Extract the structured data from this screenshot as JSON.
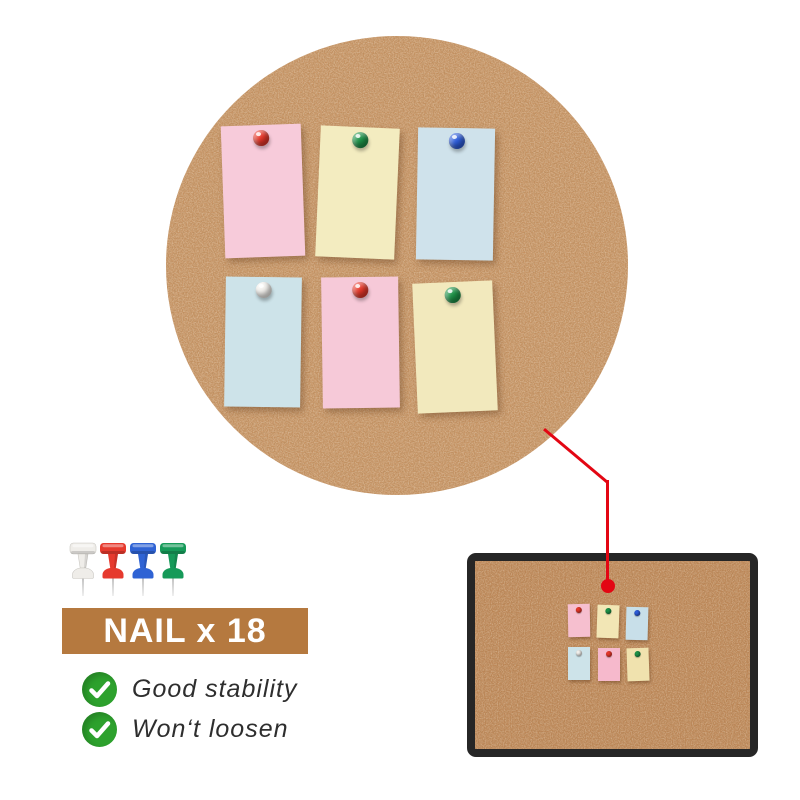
{
  "scene": {
    "type": "product-graphic",
    "subject": "cork board with push pins and sticky notes"
  },
  "hero_board": {
    "shape": "circle",
    "cork_color": "#c89363",
    "notes": [
      {
        "note": "pink",
        "note_color": "#f7cbda",
        "pin": "red",
        "pin_color": "#e8382a"
      },
      {
        "note": "yellow",
        "note_color": "#f3ecc0",
        "pin": "green",
        "pin_color": "#1d9348"
      },
      {
        "note": "blue",
        "note_color": "#cfe2eb",
        "pin": "blue",
        "pin_color": "#2d5ddb"
      },
      {
        "note": "blue",
        "note_color": "#cde3e9",
        "pin": "white",
        "pin_color": "#f4f2ee"
      },
      {
        "note": "pink",
        "note_color": "#f6c9d8",
        "pin": "red",
        "pin_color": "#e8382a"
      },
      {
        "note": "yellow",
        "note_color": "#f2e9bd",
        "pin": "green",
        "pin_color": "#1d9348"
      }
    ]
  },
  "connector": {
    "color": "#e30613"
  },
  "pin_samples": [
    {
      "name": "white",
      "color": "#efede9"
    },
    {
      "name": "red",
      "color": "#e63a2e"
    },
    {
      "name": "blue",
      "color": "#2f63d4"
    },
    {
      "name": "green",
      "color": "#169a59"
    }
  ],
  "banner": {
    "label": "NAIL x 18",
    "bg_color": "#b5793f",
    "text_color": "#ffffff"
  },
  "features": [
    {
      "label": "Good stability",
      "check_color": "#2da12d"
    },
    {
      "label": "Won‘t loosen",
      "check_color": "#2da12d"
    }
  ],
  "mini_board": {
    "frame_color": "#262626",
    "cork_color": "#bf8757",
    "notes": [
      {
        "note_color": "#f6bfcf",
        "pin_color": "#e8382a"
      },
      {
        "note_color": "#f2e6b5",
        "pin_color": "#1d9348"
      },
      {
        "note_color": "#c8dfe9",
        "pin_color": "#2d5ddb"
      },
      {
        "note_color": "#cde3e9",
        "pin_color": "#f4f2ee"
      },
      {
        "note_color": "#f6b9cc",
        "pin_color": "#e8382a"
      },
      {
        "note_color": "#f0e2ae",
        "pin_color": "#1d9348"
      }
    ]
  }
}
